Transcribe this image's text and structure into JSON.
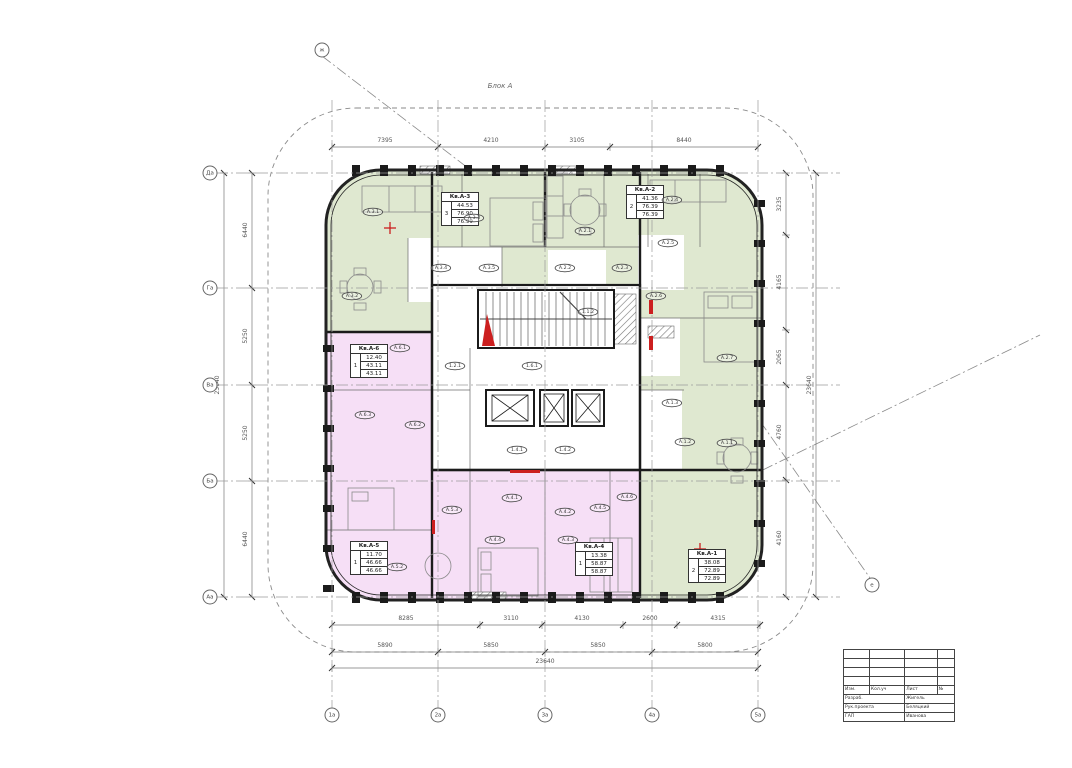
{
  "drawing": {
    "block_label": "Блок А",
    "type": "residential floor plan"
  },
  "colors": {
    "apartment_green": "#dfe8d0",
    "apartment_pink": "#f6dff6",
    "wall": "#1b1b1b",
    "dim_line": "#777777",
    "accent_red": "#cc1f1f"
  },
  "dim_chains": [
    {
      "id": "top",
      "dir": "h",
      "pos": 147,
      "from": 332,
      "to": 758,
      "ticks": [
        332,
        438,
        545,
        610,
        758
      ],
      "labels": [
        {
          "t": "7395",
          "c": 385
        },
        {
          "t": "4210",
          "c": 491
        },
        {
          "t": "3105",
          "c": 577
        },
        {
          "t": "8440",
          "c": 684
        }
      ]
    },
    {
      "id": "bottom-inner",
      "dir": "h",
      "pos": 625,
      "from": 332,
      "to": 760,
      "ticks": [
        332,
        480,
        542,
        623,
        677,
        760
      ],
      "labels": [
        {
          "t": "8285",
          "c": 406
        },
        {
          "t": "3110",
          "c": 511
        },
        {
          "t": "4130",
          "c": 582
        },
        {
          "t": "2600",
          "c": 650
        },
        {
          "t": "4315",
          "c": 718
        }
      ]
    },
    {
      "id": "bottom-outer",
      "dir": "h",
      "pos": 652,
      "from": 332,
      "to": 758,
      "ticks": [
        332,
        438,
        545,
        652,
        758
      ],
      "labels": [
        {
          "t": "5890",
          "c": 385
        },
        {
          "t": "5850",
          "c": 491
        },
        {
          "t": "5850",
          "c": 598
        },
        {
          "t": "5800",
          "c": 705
        }
      ]
    },
    {
      "id": "bottom-total",
      "dir": "h",
      "pos": 668,
      "from": 332,
      "to": 758,
      "ticks": [
        332,
        758
      ],
      "labels": [
        {
          "t": "23640",
          "c": 545
        }
      ]
    },
    {
      "id": "left-outer",
      "dir": "v",
      "pos": 224,
      "from": 173,
      "to": 597,
      "ticks": [
        173,
        597
      ],
      "labels": [
        {
          "t": "23640",
          "c": 385
        }
      ]
    },
    {
      "id": "left-inner",
      "dir": "v",
      "pos": 252,
      "from": 173,
      "to": 597,
      "ticks": [
        173,
        288,
        385,
        481,
        597
      ],
      "labels": [
        {
          "t": "6440",
          "c": 230
        },
        {
          "t": "5250",
          "c": 336
        },
        {
          "t": "5250",
          "c": 433
        },
        {
          "t": "6440",
          "c": 539
        }
      ]
    },
    {
      "id": "right-inner",
      "dir": "v",
      "pos": 786,
      "from": 173,
      "to": 597,
      "ticks": [
        173,
        235,
        330,
        385,
        480,
        597
      ],
      "labels": [
        {
          "t": "3235",
          "c": 204
        },
        {
          "t": "4165",
          "c": 282
        },
        {
          "t": "2065",
          "c": 357
        },
        {
          "t": "4760",
          "c": 432
        },
        {
          "t": "4160",
          "c": 538
        }
      ]
    },
    {
      "id": "right-outer",
      "dir": "v",
      "pos": 816,
      "from": 173,
      "to": 597,
      "ticks": [
        173,
        597
      ],
      "labels": [
        {
          "t": "23640",
          "c": 385
        }
      ]
    }
  ],
  "axes": {
    "bottom": [
      {
        "label": "1а",
        "x": 332
      },
      {
        "label": "2а",
        "x": 438
      },
      {
        "label": "3а",
        "x": 545
      },
      {
        "label": "4а",
        "x": 652
      },
      {
        "label": "5а",
        "x": 758
      }
    ],
    "left": [
      {
        "label": "Да",
        "y": 173
      },
      {
        "label": "Га",
        "y": 288
      },
      {
        "label": "Ва",
        "y": 385
      },
      {
        "label": "Ба",
        "y": 481
      },
      {
        "label": "Аа",
        "y": 597
      }
    ],
    "floating": [
      {
        "label": "ж",
        "x": 322,
        "y": 50
      },
      {
        "label": "е",
        "x": 872,
        "y": 585
      }
    ]
  },
  "apartments": [
    {
      "name": "Кв.А-3",
      "rooms": "3",
      "living": "44.53",
      "total": "76.90",
      "total_summer": "76.99",
      "x": 441,
      "y": 192
    },
    {
      "name": "Кв.А-2",
      "rooms": "2",
      "living": "41.36",
      "total": "76.39",
      "total_summer": "76.39",
      "x": 626,
      "y": 185
    },
    {
      "name": "Кв.А-6",
      "rooms": "1",
      "living": "12.40",
      "total": "43.11",
      "total_summer": "43.11",
      "x": 350,
      "y": 344
    },
    {
      "name": "Кв.А-5",
      "rooms": "1",
      "living": "11.70",
      "total": "46.66",
      "total_summer": "46.66",
      "x": 350,
      "y": 541
    },
    {
      "name": "Кв.А-4",
      "rooms": "1",
      "living": "13.38",
      "total": "58.87",
      "total_summer": "58.87",
      "x": 575,
      "y": 542
    },
    {
      "name": "Кв.А-1",
      "rooms": "2",
      "living": "38.08",
      "total": "72.89",
      "total_summer": "72.89",
      "x": 688,
      "y": 549
    }
  ],
  "room_labels": [
    {
      "code": "А.3.1",
      "x": 373,
      "y": 212
    },
    {
      "code": "А.3.3",
      "x": 474,
      "y": 218
    },
    {
      "code": "А.3.2",
      "x": 352,
      "y": 296
    },
    {
      "code": "А.3.4",
      "x": 441,
      "y": 268
    },
    {
      "code": "А.3.5",
      "x": 489,
      "y": 268
    },
    {
      "code": "А.2.1",
      "x": 585,
      "y": 231
    },
    {
      "code": "А.2.2",
      "x": 565,
      "y": 268
    },
    {
      "code": "А.2.3",
      "x": 622,
      "y": 268
    },
    {
      "code": "А.2.4",
      "x": 672,
      "y": 200
    },
    {
      "code": "А.2.5",
      "x": 668,
      "y": 243
    },
    {
      "code": "А.2.6",
      "x": 656,
      "y": 296
    },
    {
      "code": "А.2.7",
      "x": 727,
      "y": 358
    },
    {
      "code": "А.1.3",
      "x": 672,
      "y": 403
    },
    {
      "code": "А.1.2",
      "x": 685,
      "y": 442
    },
    {
      "code": "А.1.1",
      "x": 727,
      "y": 443
    },
    {
      "code": "А.6.1",
      "x": 400,
      "y": 348
    },
    {
      "code": "А.6.2",
      "x": 415,
      "y": 425
    },
    {
      "code": "А.6.3",
      "x": 365,
      "y": 415
    },
    {
      "code": "А.5.2",
      "x": 397,
      "y": 567
    },
    {
      "code": "А.5.3",
      "x": 452,
      "y": 510
    },
    {
      "code": "А.4.1",
      "x": 512,
      "y": 498
    },
    {
      "code": "А.4.4",
      "x": 495,
      "y": 540
    },
    {
      "code": "А.4.2",
      "x": 565,
      "y": 512
    },
    {
      "code": "А.4.3",
      "x": 568,
      "y": 540
    },
    {
      "code": "А.4.5",
      "x": 600,
      "y": 508
    },
    {
      "code": "А.4.6",
      "x": 627,
      "y": 497
    },
    {
      "code": "1.1.2",
      "x": 588,
      "y": 312
    },
    {
      "code": "1.2.1",
      "x": 455,
      "y": 366
    },
    {
      "code": "1.6.1",
      "x": 532,
      "y": 366
    },
    {
      "code": "1.4.1",
      "x": 517,
      "y": 450
    },
    {
      "code": "1.4.2",
      "x": 565,
      "y": 450
    }
  ],
  "red_marks": [
    {
      "type": "tri",
      "points": "482,346 495,346 487,314"
    },
    {
      "type": "plus",
      "x": 390,
      "y": 228
    },
    {
      "type": "plus",
      "x": 700,
      "y": 549
    },
    {
      "type": "rect",
      "x": 649,
      "y": 300,
      "w": 4,
      "h": 14
    },
    {
      "type": "rect",
      "x": 649,
      "y": 336,
      "w": 4,
      "h": 14
    },
    {
      "type": "rect",
      "x": 510,
      "y": 470,
      "w": 30,
      "h": 3
    },
    {
      "type": "rect",
      "x": 432,
      "y": 520,
      "w": 3,
      "h": 14
    }
  ],
  "title_block": {
    "header": [
      "Изм.",
      "Кол.уч",
      "Лист",
      "№"
    ],
    "rows": [
      {
        "label": "Разраб.",
        "value": "Жигель"
      },
      {
        "label": "Рук.проекта",
        "value": "Беляцкий"
      },
      {
        "label": "ГАП",
        "value": "Иванова"
      }
    ]
  }
}
